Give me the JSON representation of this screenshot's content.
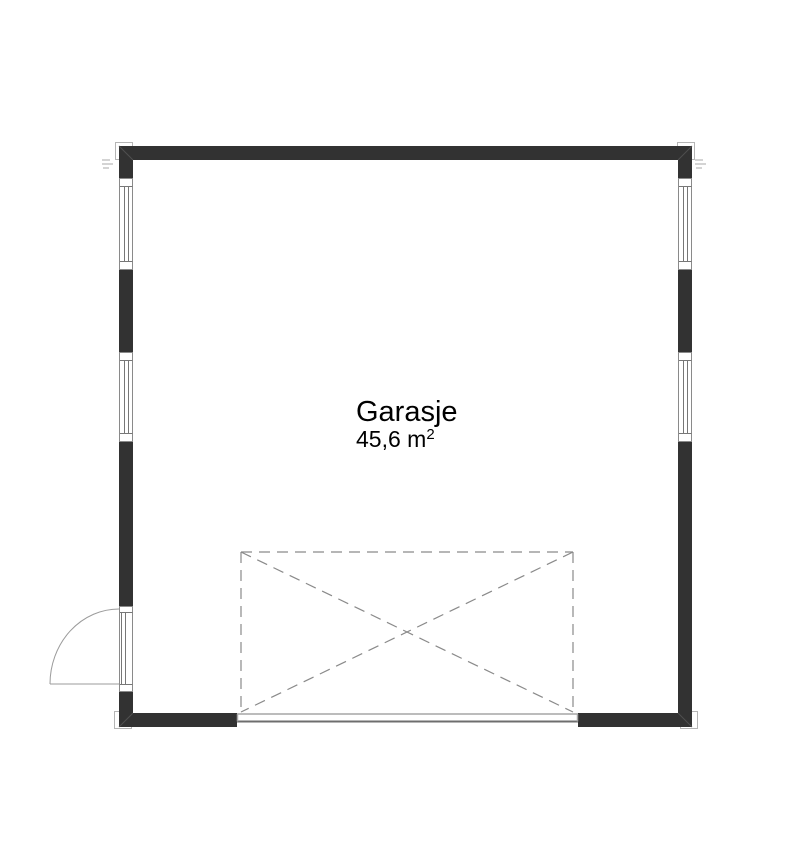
{
  "plan": {
    "room": {
      "name": "Garasje",
      "area_value": "45,6 m",
      "area_exponent": "2"
    }
  },
  "colors": {
    "bg": "#ffffff",
    "wall": "#323232",
    "frame": "#8a8a8a",
    "pane": "#777777",
    "swing": "#9b9b9b",
    "dashed": "#8a8a8a",
    "threshold-light": "#a6a6a6",
    "threshold-dark": "#6e6e6e",
    "post": "#b5b5b5",
    "miter": "#4f4f4f",
    "micro": "#aaaaaa",
    "text": "#000000"
  }
}
